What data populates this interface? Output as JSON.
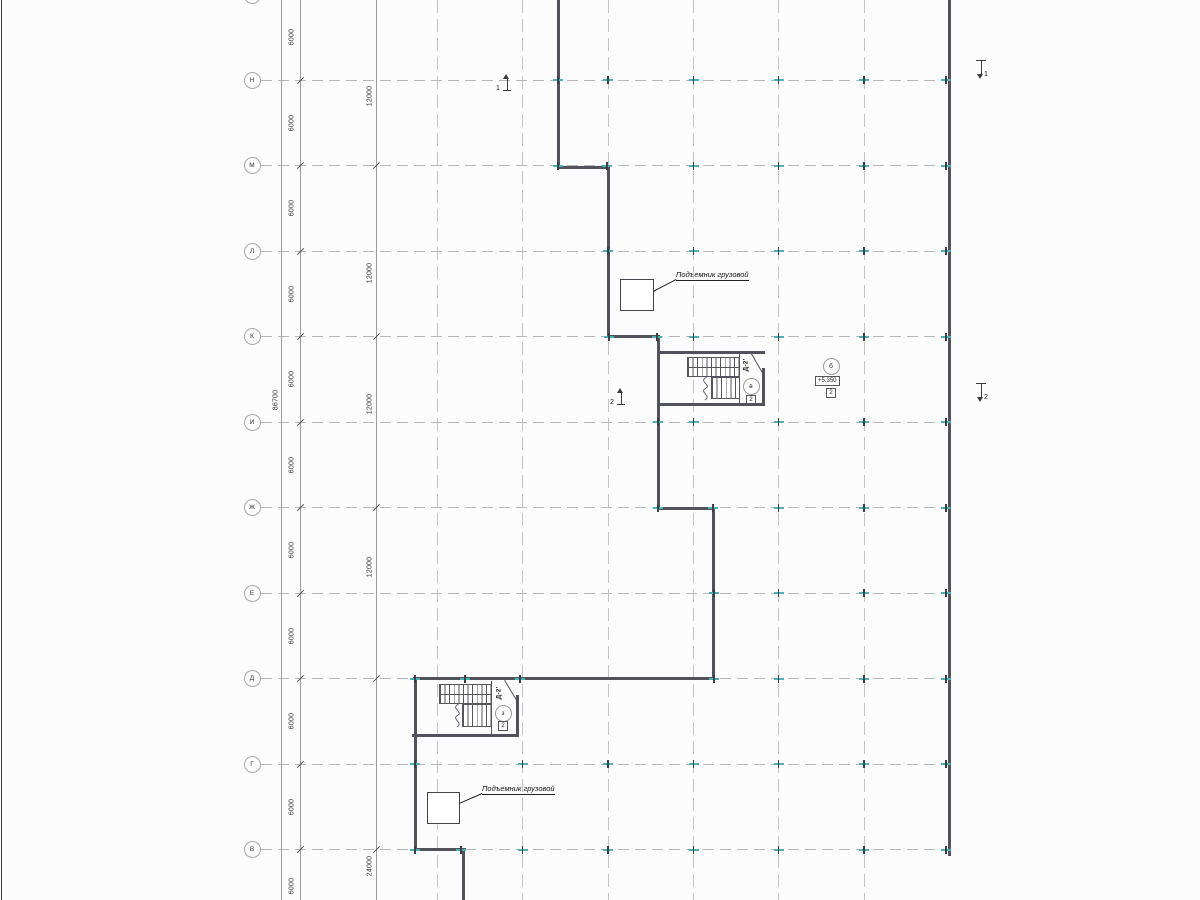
{
  "title": "Floor plan drawing",
  "colors": {
    "wall": "#52525a",
    "grid": "#b7b7b7",
    "teal_tick": "#49b2b4",
    "dim_line": "#9c9c9c",
    "text": "#333333"
  },
  "axes": {
    "circle_x": 252,
    "partial_top_circle_y": -13,
    "row_line": {
      "x1": 261,
      "x2": 948
    },
    "rows": [
      {
        "label": "Н",
        "y": 80
      },
      {
        "label": "М",
        "y": 165.5
      },
      {
        "label": "Л",
        "y": 251
      },
      {
        "label": "К",
        "y": 336.5
      },
      {
        "label": "И",
        "y": 422
      },
      {
        "label": "Ж",
        "y": 507.5
      },
      {
        "label": "Е",
        "y": 593
      },
      {
        "label": "Д",
        "y": 678.5
      },
      {
        "label": "Г",
        "y": 764
      },
      {
        "label": "В",
        "y": 849.5
      }
    ],
    "columns": [
      437,
      522.5,
      608,
      693.5,
      778.5,
      864
    ]
  },
  "dims": {
    "chain6000": {
      "x": 299.5,
      "label_x": 292,
      "labels": [
        {
          "text": "6000",
          "y": 37
        },
        {
          "text": "6000",
          "y": 123
        },
        {
          "text": "6000",
          "y": 208
        },
        {
          "text": "6000",
          "y": 294
        },
        {
          "text": "6000",
          "y": 379
        },
        {
          "text": "6000",
          "y": 465
        },
        {
          "text": "6000",
          "y": 550
        },
        {
          "text": "6000",
          "y": 636
        },
        {
          "text": "6000",
          "y": 721
        },
        {
          "text": "6000",
          "y": 807
        },
        {
          "text": "6000",
          "y": 886
        }
      ],
      "tick_ys": [
        80,
        165.5,
        251,
        336.5,
        422,
        507.5,
        593,
        678.5,
        764,
        849.5
      ]
    },
    "overall": {
      "x": 281,
      "text": "86700",
      "pos": [
        276,
        400
      ]
    },
    "chain2": {
      "x": 376,
      "label_x": 370,
      "labels": [
        {
          "text": "12000",
          "y": 96
        },
        {
          "text": "12000",
          "y": 273
        },
        {
          "text": "12000",
          "y": 404
        },
        {
          "text": "12000",
          "y": 567
        },
        {
          "text": "24000",
          "y": 866
        }
      ],
      "tick_ys": [
        165.5,
        336.5,
        507.5,
        678.5,
        849.5
      ]
    }
  },
  "walls": [
    [
      557,
      0,
      3,
      169
    ],
    [
      557,
      166,
      53,
      3
    ],
    [
      607,
      169,
      3,
      169
    ],
    [
      607,
      335,
      53,
      3
    ],
    [
      657,
      338,
      3,
      172
    ],
    [
      657,
      507,
      58,
      3
    ],
    [
      712,
      510,
      3,
      170
    ],
    [
      413,
      677,
      302,
      3
    ],
    [
      414,
      680,
      3,
      171
    ],
    [
      414,
      848,
      52,
      3
    ],
    [
      462,
      851,
      3,
      49
    ],
    [
      948,
      0,
      3,
      856
    ]
  ],
  "ticks": [
    {
      "y": 80,
      "xs": [
        558,
        608,
        693.5,
        778.5,
        864,
        946
      ]
    },
    {
      "y": 165.5,
      "xs": [
        558,
        607,
        693.5,
        778.5,
        864,
        946
      ]
    },
    {
      "y": 251,
      "xs": [
        608,
        693.5,
        778.5,
        864,
        946
      ]
    },
    {
      "y": 336.5,
      "xs": [
        609,
        657,
        693.5,
        778.5,
        864,
        946
      ]
    },
    {
      "y": 422,
      "xs": [
        658,
        693.5,
        778.5,
        864,
        946
      ]
    },
    {
      "y": 507.5,
      "xs": [
        658,
        713,
        778.5,
        864,
        946
      ]
    },
    {
      "y": 593,
      "xs": [
        714,
        778.5,
        864,
        946
      ]
    },
    {
      "y": 678.5,
      "xs": [
        415,
        465,
        520,
        714,
        778.5,
        864,
        946
      ]
    },
    {
      "y": 764,
      "xs": [
        415,
        522.5,
        608,
        693.5,
        778.5,
        864,
        946
      ]
    },
    {
      "y": 849.5,
      "xs": [
        415,
        461,
        522.5,
        608,
        693.5,
        778.5,
        864,
        946
      ]
    }
  ],
  "stairs": [
    {
      "tag": "Д-2'",
      "circle_label": "в",
      "box_label": "2",
      "geom": {
        "top": [
          657,
          351,
          108,
          2.5
        ],
        "bottom": [
          657,
          403,
          108,
          2.5
        ],
        "right": [
          762,
          368,
          2.5,
          37
        ],
        "inner_v": [
          739,
          353,
          1,
          50
        ],
        "mid": [
          687,
          367,
          53,
          0.9
        ],
        "flightA": [
          687,
          357,
          53,
          20
        ],
        "flightB": [
          711,
          377,
          29,
          22
        ],
        "wavy": [
          700,
          377,
          11,
          23
        ],
        "door": {
          "x": 751,
          "y": 352,
          "len": 24,
          "angle": 60
        },
        "tag_pos": [
          746,
          365
        ],
        "circle_pos": [
          742.5,
          377.5
        ],
        "box_pos": [
          746,
          394.5
        ]
      }
    },
    {
      "tag": "Д-2'",
      "circle_label": "з",
      "box_label": "2",
      "geom": {
        "bottom": [
          412,
          734,
          107,
          2.5
        ],
        "right": [
          516,
          695,
          2.5,
          41
        ],
        "inner_v": [
          491,
          681,
          1,
          54
        ],
        "mid": [
          439,
          694,
          53,
          0.9
        ],
        "flightA": [
          439,
          684,
          53,
          20
        ],
        "flightB": [
          462,
          704,
          30,
          23
        ],
        "wavy": [
          452,
          704,
          11,
          23
        ],
        "door": {
          "x": 505,
          "y": 680,
          "len": 23,
          "angle": 59
        },
        "tag_pos": [
          499,
          693
        ],
        "circle_pos": [
          494.5,
          704.5
        ],
        "box_pos": [
          498,
          721
        ]
      }
    }
  ],
  "lifts": [
    {
      "label": "Подъемник грузовой",
      "rect": [
        620,
        279,
        34,
        32
      ],
      "diag": {
        "x": 653,
        "y": 291,
        "len": 26,
        "angle": -27.5
      },
      "text_pos": [
        676,
        270
      ]
    },
    {
      "label": "Подъемник грузовой",
      "rect": [
        427,
        792,
        33,
        32
      ],
      "diag": {
        "x": 459,
        "y": 803,
        "len": 25,
        "angle": -23.5
      },
      "text_pos": [
        482,
        784
      ]
    }
  ],
  "level_mark": {
    "circle_label": "б",
    "elevation": "+5.350",
    "box_label": "2",
    "circle_pos": [
      822.5,
      357.5
    ],
    "elev_pos": [
      815,
      376
    ],
    "box_pos": [
      826,
      388
    ]
  },
  "sections": [
    {
      "n": "1",
      "pos": [
        497,
        74
      ],
      "dir": "up"
    },
    {
      "n": "1",
      "pos": [
        971,
        57
      ],
      "dir": "down"
    },
    {
      "n": "2",
      "pos": [
        611,
        388
      ],
      "dir": "up"
    },
    {
      "n": "2",
      "pos": [
        971,
        380
      ],
      "dir": "down"
    }
  ],
  "frame": {
    "left_line": [
      1,
      0,
      1.3,
      900
    ]
  }
}
